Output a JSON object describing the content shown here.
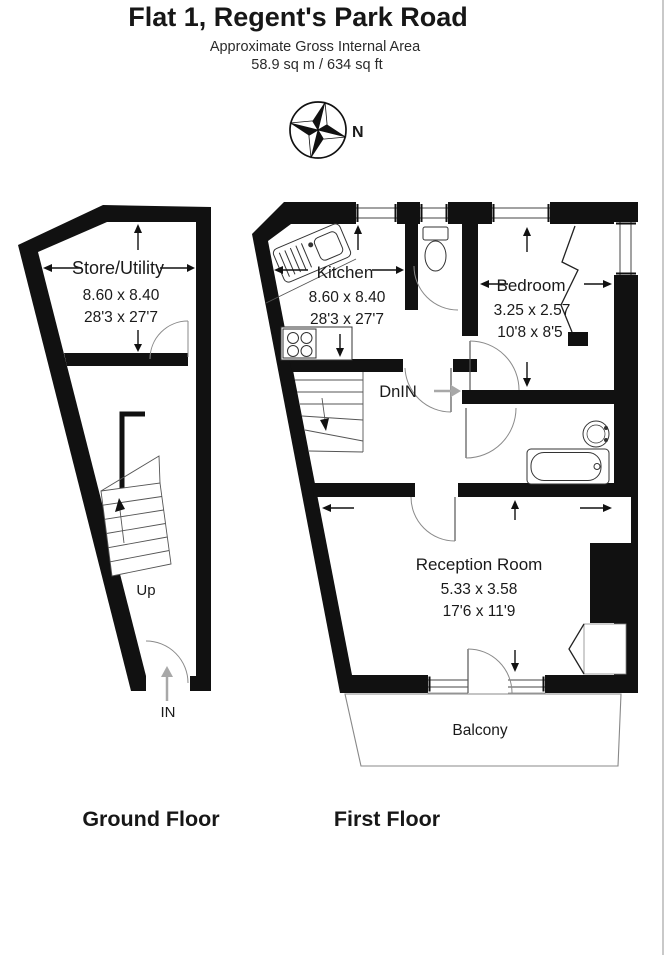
{
  "header": {
    "title": "Flat 1, Regent's Park Road",
    "subtitle": "Approximate Gross Internal Area",
    "area": "58.9 sq m / 634 sq ft"
  },
  "compass": {
    "north_label": "N"
  },
  "ground_floor": {
    "caption": "Ground Floor",
    "store_utility": {
      "name": "Store/Utility",
      "dims_m": "8.60 x 8.40",
      "dims_ft": "28'3 x 27'7"
    },
    "stairs_label": "Up",
    "entrance_label": "IN"
  },
  "first_floor": {
    "caption": "First Floor",
    "kitchen": {
      "name": "Kitchen",
      "dims_m": "8.60 x 8.40",
      "dims_ft": "28'3 x 27'7"
    },
    "bedroom": {
      "name": "Bedroom",
      "dims_m": "3.25 x 2.57",
      "dims_ft": "10'8 x 8'5"
    },
    "reception": {
      "name": "Reception Room",
      "dims_m": "5.33 x 3.58",
      "dims_ft": "17'6 x 11'9"
    },
    "balcony": {
      "name": "Balcony"
    },
    "stairs_label": "DnIN"
  },
  "colors": {
    "wall": "#111111",
    "thin_line": "#444444",
    "door_arc": "#8a8a8a",
    "grey_arrow": "#a8a8a8",
    "page_edge": "#c9c9c9"
  }
}
